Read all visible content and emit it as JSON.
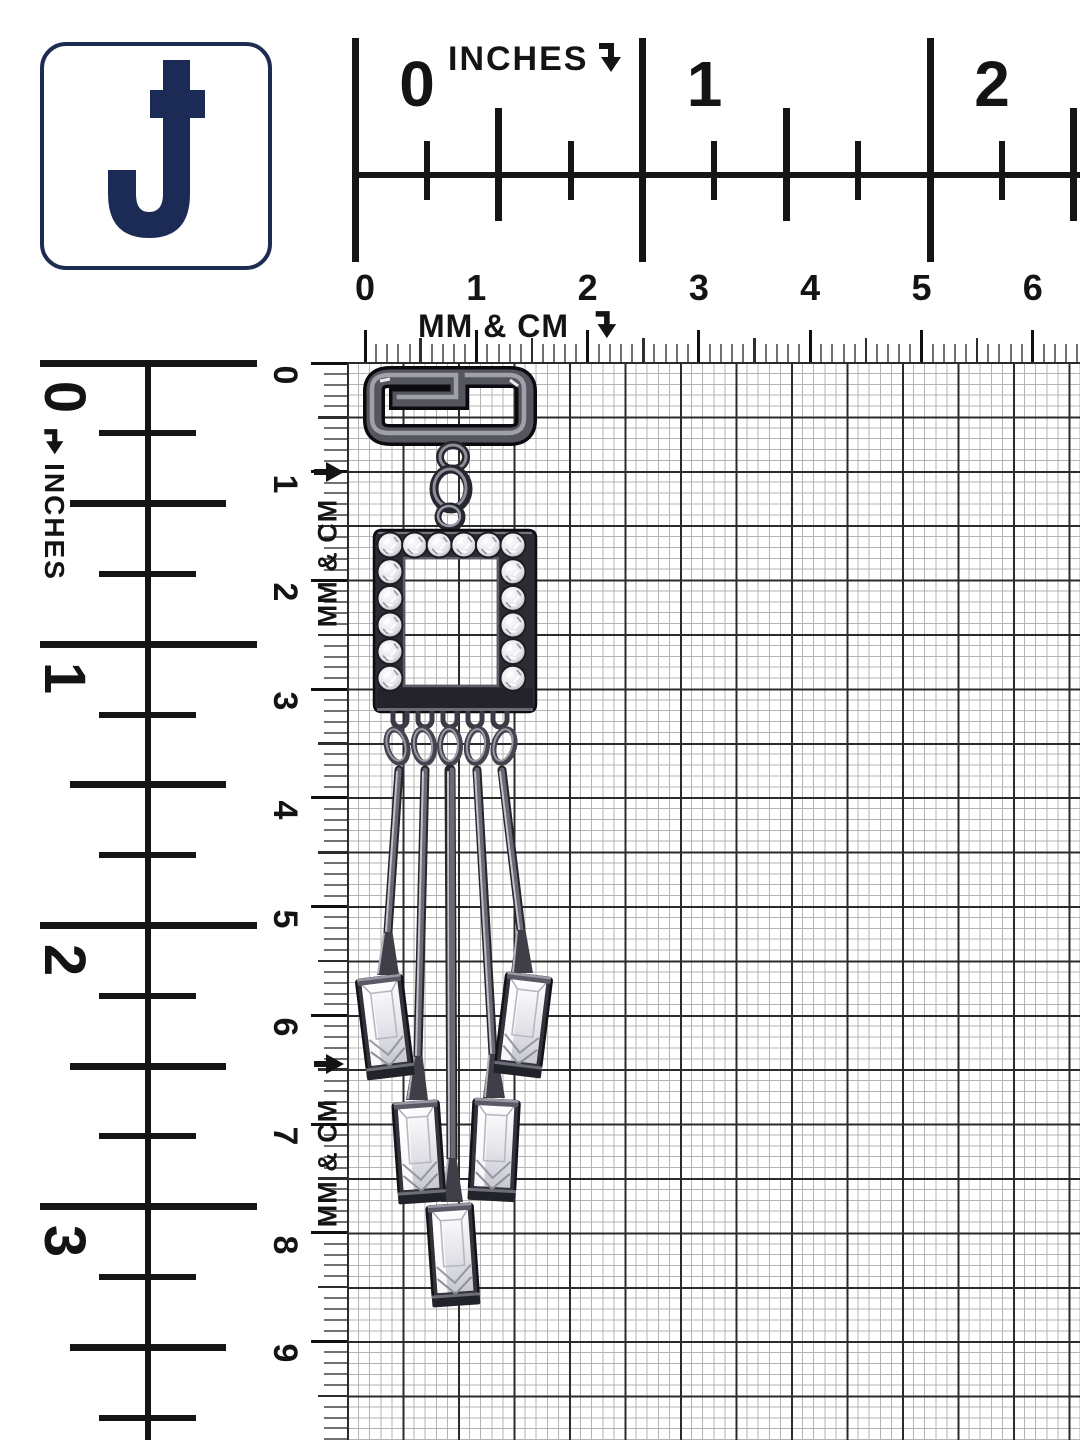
{
  "brand": {
    "logo_letter": "J",
    "logo_color": "#1c2b55"
  },
  "rulers": {
    "top_inches": {
      "label": "INCHES",
      "arrow": "down",
      "numbers": [
        "0",
        "1",
        "2"
      ]
    },
    "top_cm": {
      "label": "MM & CM",
      "arrow": "down",
      "numbers": [
        "0",
        "1",
        "2",
        "3",
        "4",
        "5",
        "6"
      ]
    },
    "left_inches": {
      "label": "INCHES",
      "arrow": "down",
      "numbers": [
        "0",
        "1",
        "2",
        "3"
      ]
    },
    "left_cm": {
      "label": "MM & CM",
      "arrow": "right",
      "numbers": [
        "0",
        "1",
        "2",
        "3",
        "4",
        "5",
        "6",
        "7",
        "8",
        "9"
      ]
    }
  },
  "subject": {
    "kind": "gunmetal-crystal-drop-earring"
  },
  "colors": {
    "navy": "#1c2b55",
    "grid_minor": "#b4b4b4",
    "grid_major": "#2b2b2b",
    "metal_dark": "#0b0b0f",
    "metal_mid": "#55555e",
    "metal_light": "#a8a8b4",
    "crystal": "#f2f2f6"
  }
}
